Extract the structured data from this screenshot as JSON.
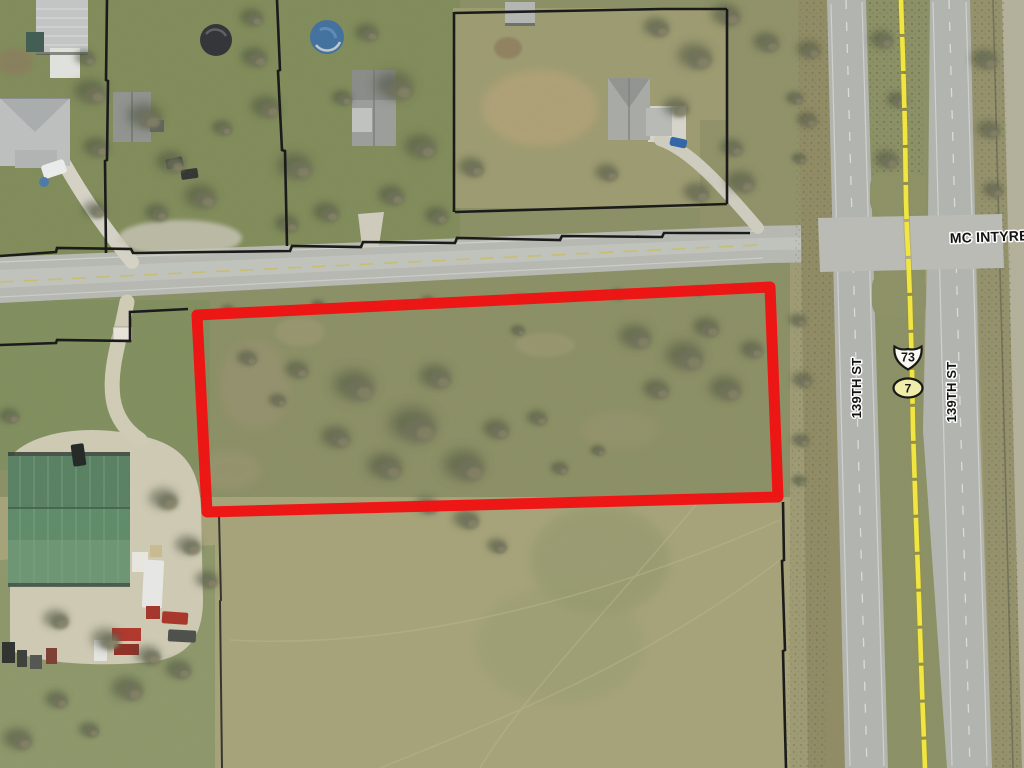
{
  "annotations": {
    "street_label": "MC INTYRE",
    "cross_street_label_west": "139TH ST",
    "cross_street_label_east": "139TH ST",
    "us_route_shield_number": "73",
    "state_route_shield_number": "7"
  },
  "colors": {
    "parcel_highlight_outline": "#f30b0b",
    "route_overlay_line": "#f4e83c",
    "parcel_boundary_line": "#141414",
    "label_text": "#0b0b0b",
    "label_halo": "#ffffff",
    "barn_roof": "#5d8a68",
    "pool_water": "#3f6f9f"
  }
}
